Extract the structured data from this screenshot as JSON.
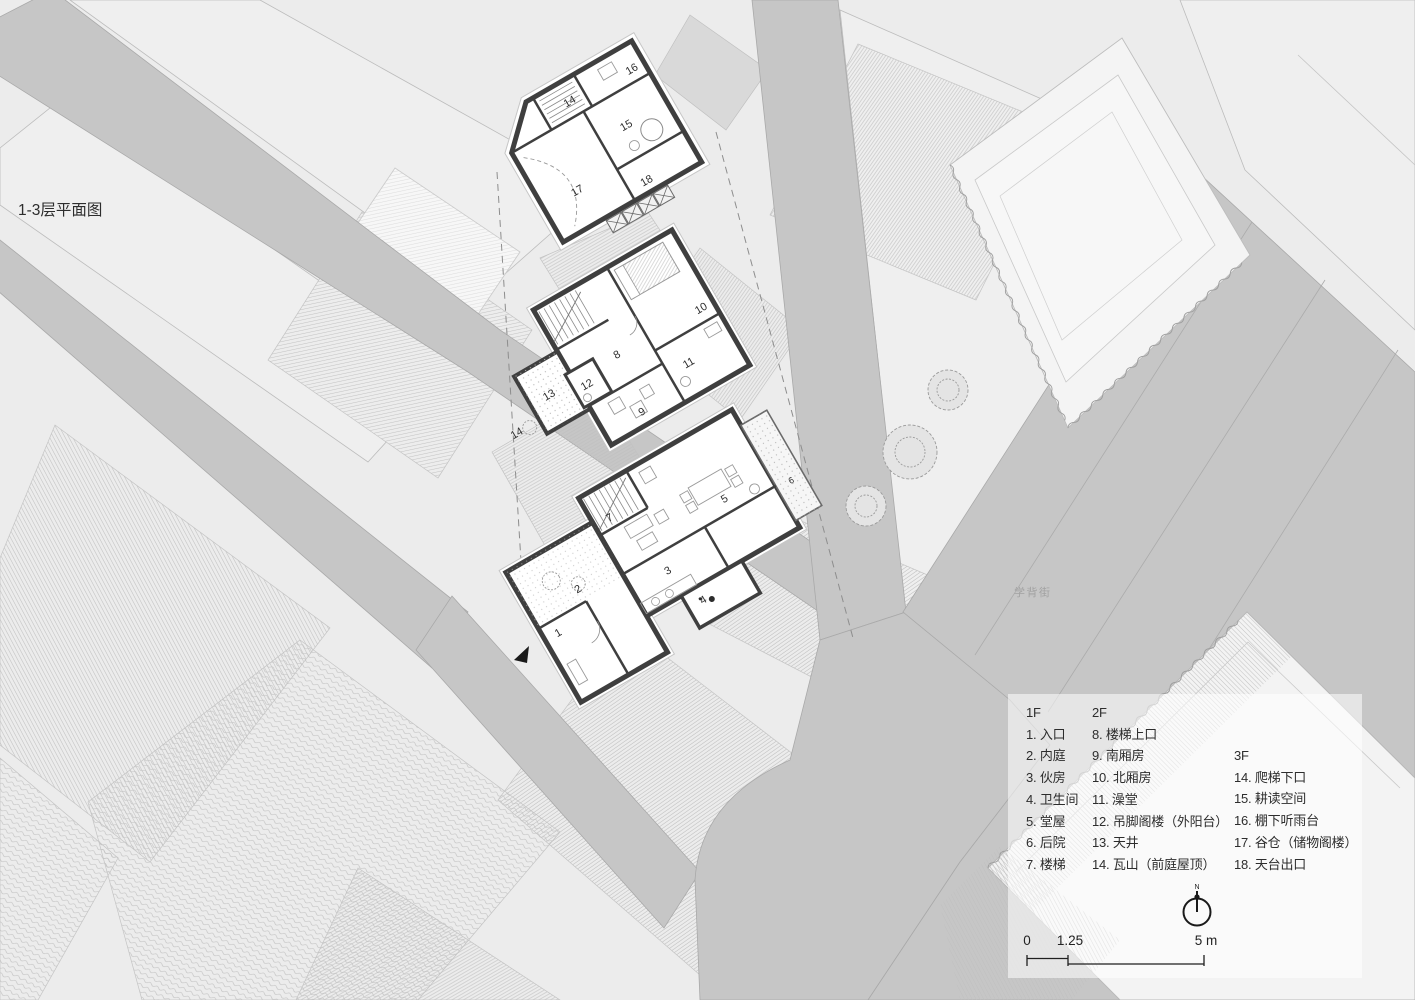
{
  "colors": {
    "background": "#ececec",
    "street": "#c6c6c6",
    "wall": "#3f3f3f",
    "hatch": "#bdbdbd"
  },
  "street_label": "学背街",
  "plans": {
    "f1": {
      "floor": "1F",
      "rooms": [
        "1",
        "2",
        "3",
        "4",
        "5",
        "6",
        "7"
      ]
    },
    "f2": {
      "floor": "2F",
      "rooms": [
        "8",
        "9",
        "10",
        "11",
        "12",
        "13",
        "14"
      ]
    },
    "f3": {
      "floor": "3F",
      "rooms": [
        "14",
        "15",
        "16",
        "17",
        "18"
      ]
    }
  },
  "legend": {
    "columns": [
      {
        "header": "1F",
        "items": [
          "1. 入口",
          "2. 内庭",
          "3. 伙房",
          "4. 卫生间",
          "5. 堂屋",
          "6. 后院",
          "7. 楼梯"
        ]
      },
      {
        "header": "2F",
        "items": [
          "8. 楼梯上口",
          "9. 南厢房",
          "10. 北厢房",
          "11. 澡堂",
          "12. 吊脚阁楼（外阳台）",
          "13. 天井",
          "14. 瓦山（前庭屋顶）"
        ]
      },
      {
        "header": "3F",
        "items": [
          "14. 爬梯下口",
          "15. 耕读空间",
          "16. 棚下听雨台",
          "17. 谷仓（储物阁楼）",
          "18. 天台出口"
        ]
      }
    ],
    "caption": "1-3层平面图",
    "north_label": "N",
    "scale": {
      "start": "0",
      "mid": "1.25",
      "end": "5 m"
    }
  }
}
